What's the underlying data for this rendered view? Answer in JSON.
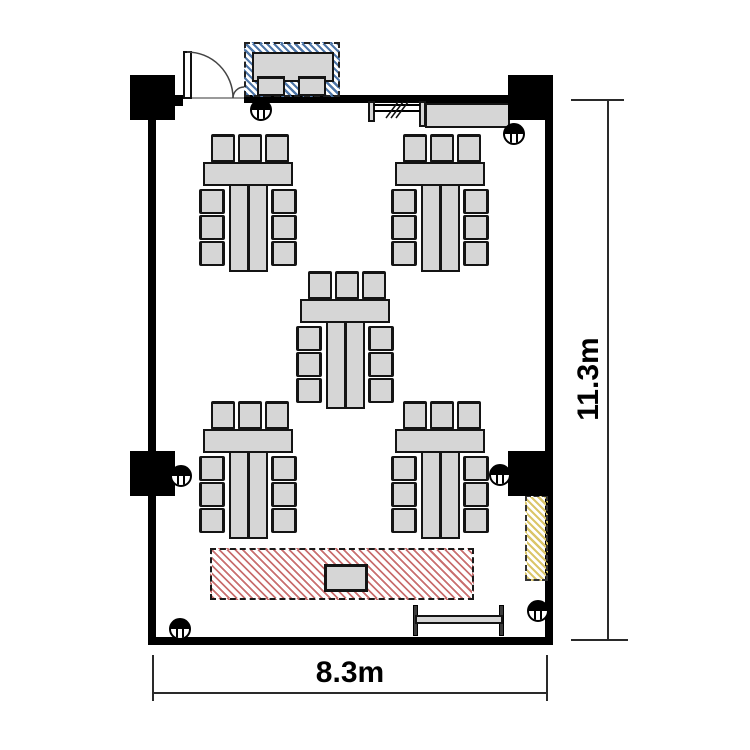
{
  "dimension_labels": {
    "width": "8.3m",
    "height": "11.3m"
  },
  "colors": {
    "wall": "#000000",
    "furniture_fill": "#d6d6d6",
    "furniture_border": "#141414",
    "stage_hatch": "#c96f6f",
    "reception_hatch": "#4e76a8",
    "side_zone_hatch": "#dbc66a",
    "dimension_line": "#2a2a2a"
  },
  "floor_plan": {
    "room": {
      "width_label": "8.3m",
      "height_label": "11.3m"
    },
    "table_groups": [
      {
        "id": "top-left",
        "x": 198,
        "y": 133,
        "chairs": 9,
        "tables": 3
      },
      {
        "id": "top-right",
        "x": 390,
        "y": 133,
        "chairs": 9,
        "tables": 3
      },
      {
        "id": "center",
        "x": 295,
        "y": 270,
        "chairs": 9,
        "tables": 3
      },
      {
        "id": "bottom-left",
        "x": 198,
        "y": 400,
        "chairs": 9,
        "tables": 3
      },
      {
        "id": "bottom-right",
        "x": 390,
        "y": 400,
        "chairs": 9,
        "tables": 3
      }
    ],
    "columns": [
      {
        "x": 130,
        "y": 75
      },
      {
        "x": 508,
        "y": 75
      },
      {
        "x": 130,
        "y": 451
      },
      {
        "x": 508,
        "y": 451
      }
    ],
    "column_markers": [
      {
        "x": 261,
        "y": 110
      },
      {
        "x": 514,
        "y": 134
      },
      {
        "x": 181,
        "y": 476
      },
      {
        "x": 500,
        "y": 475
      },
      {
        "x": 180,
        "y": 629
      },
      {
        "x": 538,
        "y": 611
      }
    ],
    "reception_zone": {
      "chairs": 2,
      "tables": 1
    },
    "stage_zone": {
      "podium": 1
    }
  }
}
